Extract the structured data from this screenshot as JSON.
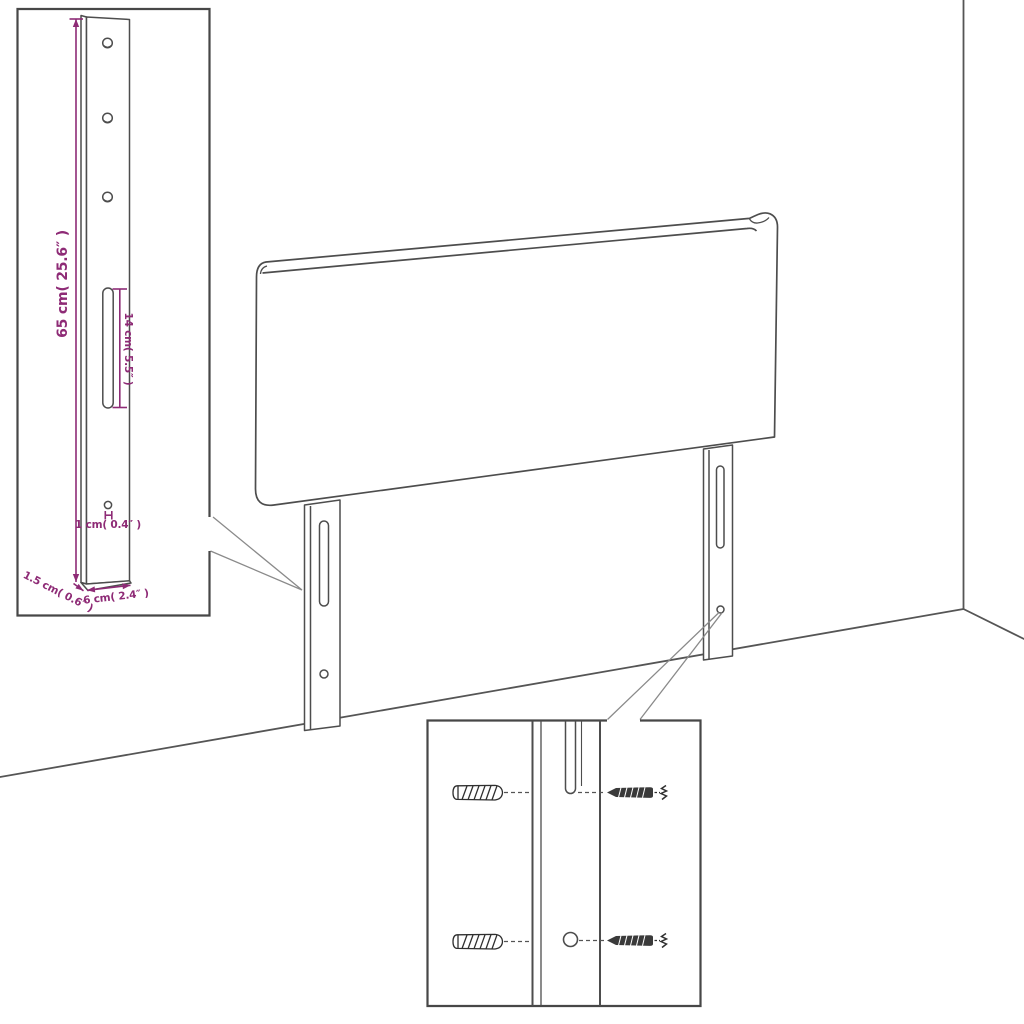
{
  "colors": {
    "dimension": "#8e2b76",
    "line_art": "#4d4d4d",
    "leader": "#8a8a8a",
    "background": "#ffffff"
  },
  "bracket_detail": {
    "height_label": "65 cm( 25.6″ )",
    "slot_label": "14 cm( 5.5″ )",
    "hole_label": "1 cm( 0.4″ )",
    "thickness_label": "1.5 cm( 0.6″ )",
    "width_label": "6 cm( 2.4″ )"
  },
  "hardware_detail": {
    "wall_plug_count": 2,
    "screw_count": 2
  }
}
